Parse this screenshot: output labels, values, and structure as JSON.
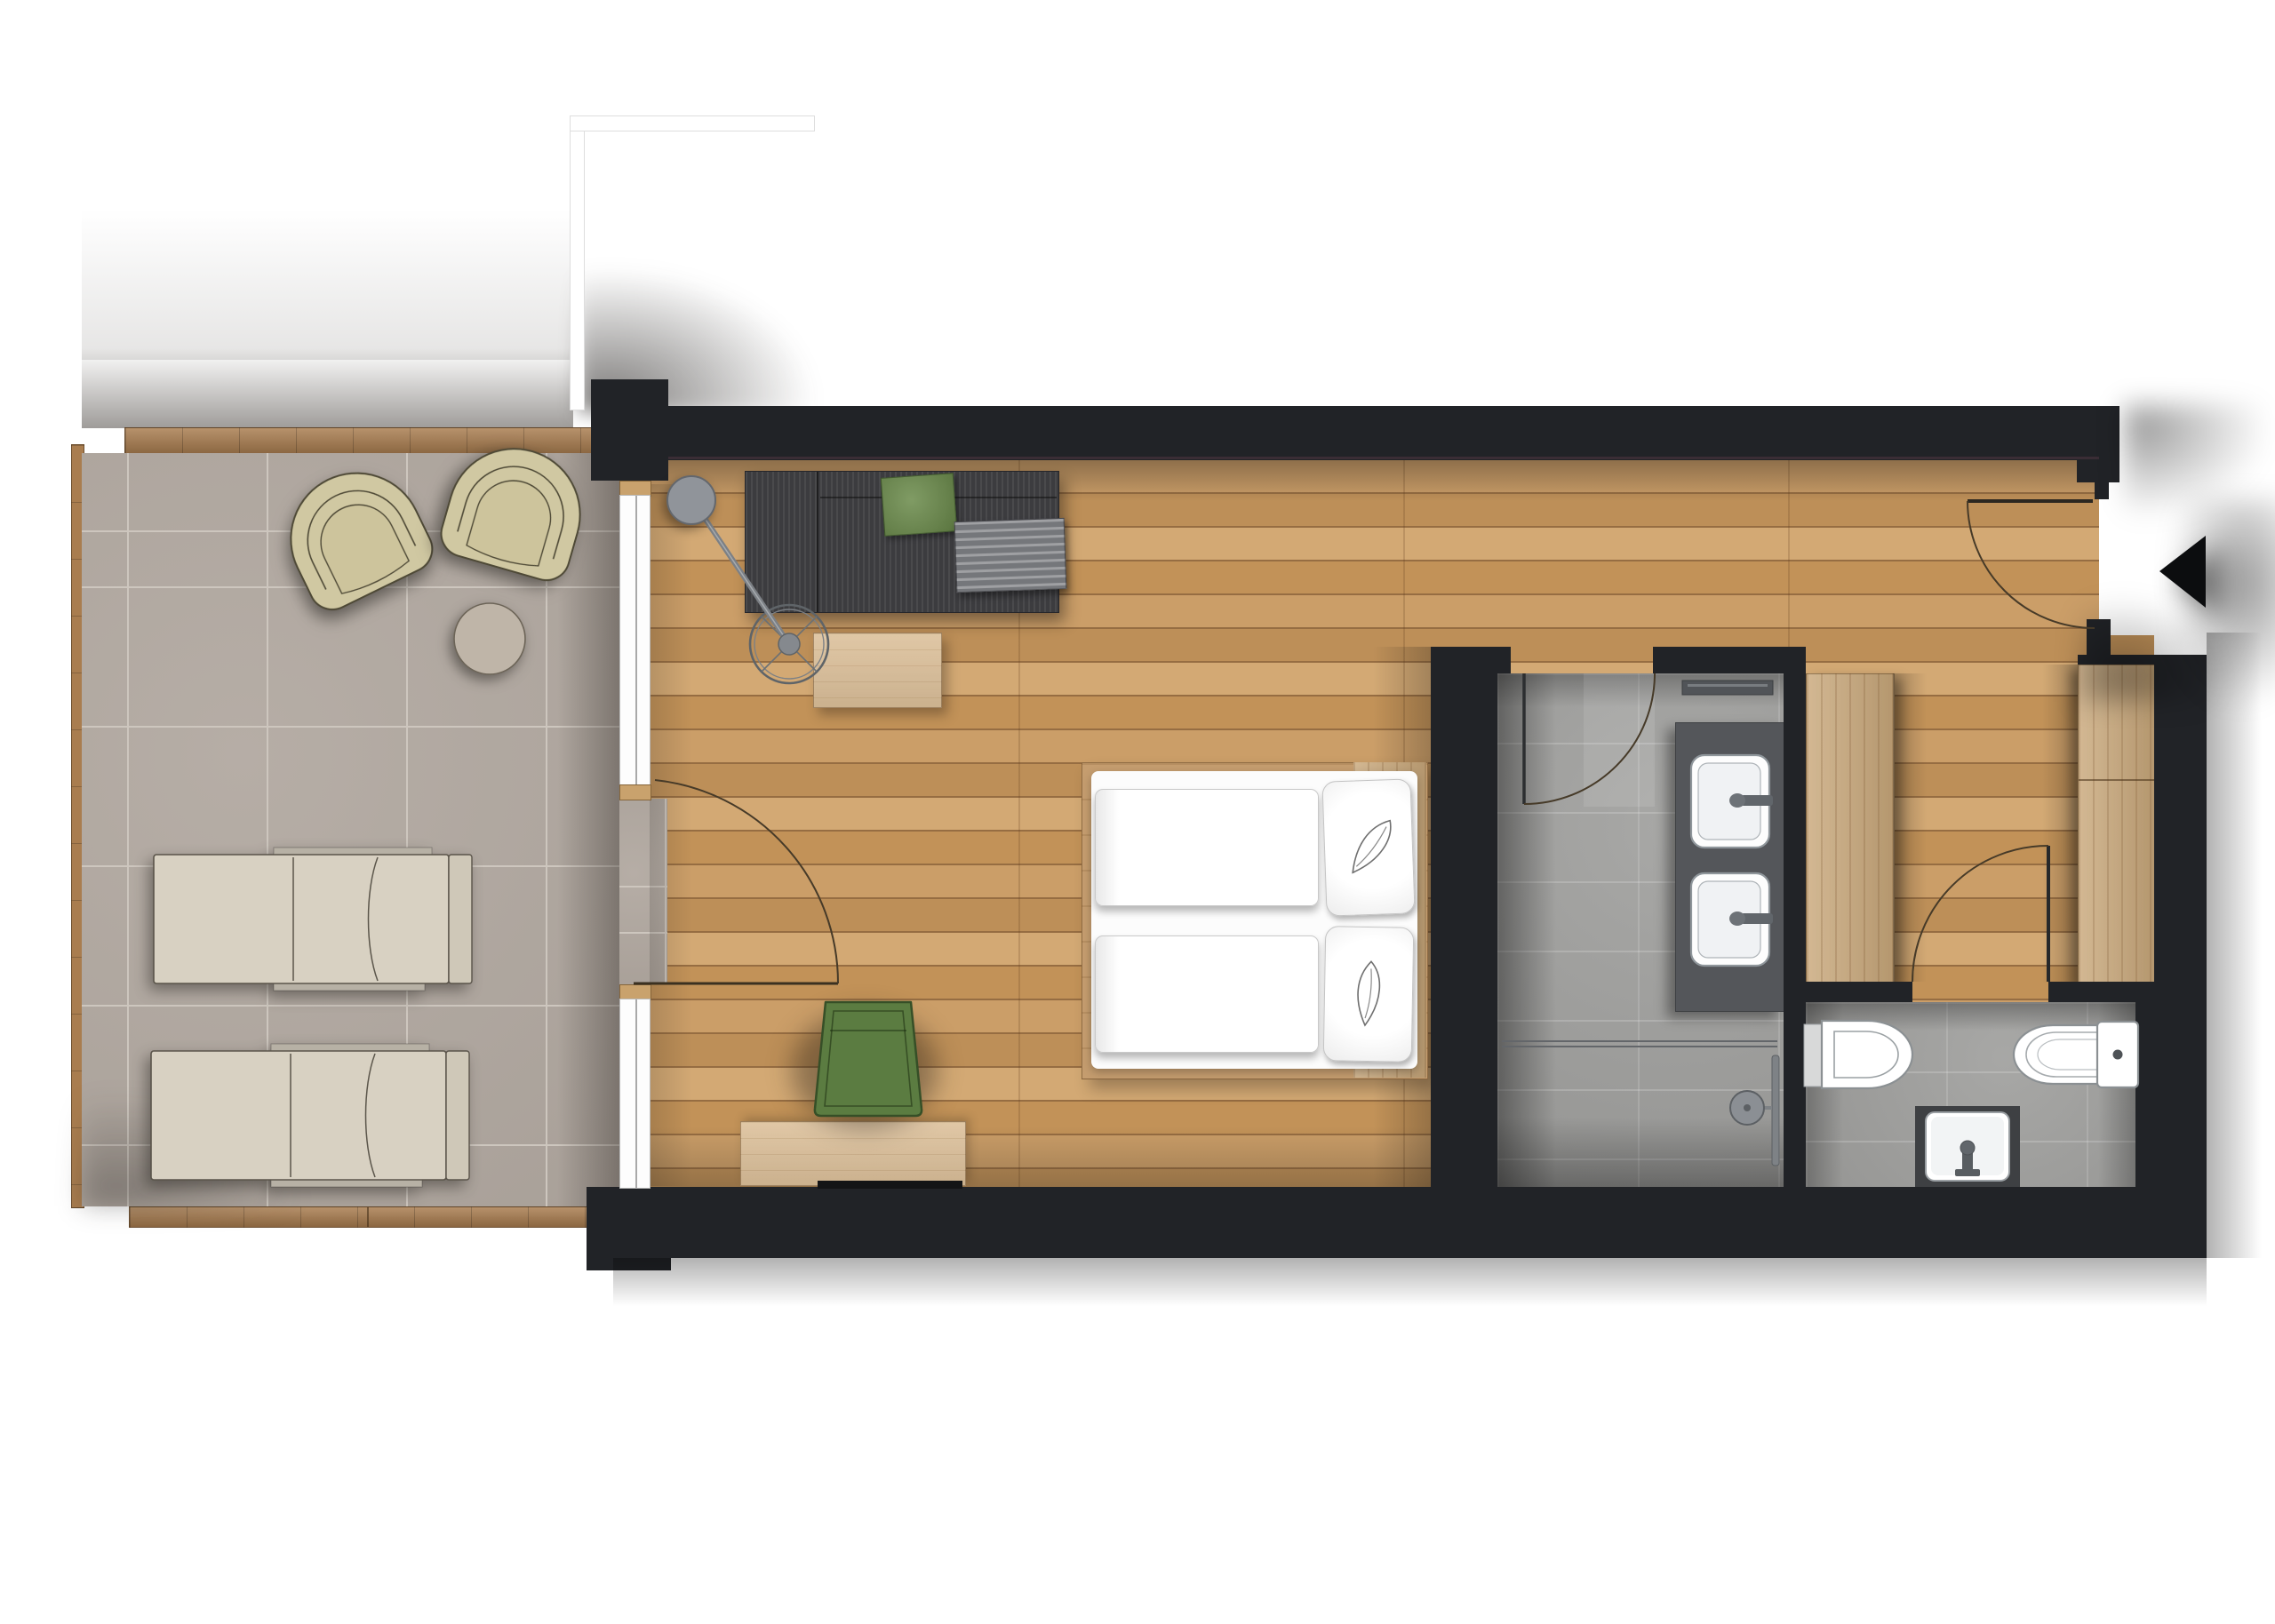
{
  "meta": {
    "kind": "architectural floor plan",
    "view": "top-down rendered plan",
    "scene": "hotel guest room with bathroom, separate WC, entrance hall and terrace",
    "visible_text": "none"
  },
  "colors": {
    "background": "#ffffff",
    "wall": "#212327",
    "wood_floor": "#c49561",
    "terrace_tile": "#b2a9a1",
    "terrace_grout": "#cdc6be",
    "deck_wood": "#a97d4f",
    "bath_tile": "#a2a2a0",
    "vanity_counter": "#54565a",
    "fixture_white": "#fdfdfd",
    "sofa": "#3c3c3f",
    "blanket": "#75777b",
    "cushion_green": "#6b8b4b",
    "armchair_green": "#5b7c41",
    "outdoor_chair": "#d0c8a2",
    "lounger": "#d8d1c2",
    "light_wood": "#dcc09a",
    "closet_wood": "#c9a87b",
    "bed_platform": "#c59d6f",
    "door_arc": "#463a28",
    "entrance_arrow": "#0c0d0f"
  },
  "rooms": {
    "terrace": {
      "label": "Terrace",
      "floor": "stone tile grid with wood deck edging",
      "items": {
        "armchair_left": "outdoor lounge chair",
        "armchair_right": "outdoor lounge chair",
        "side_table": "round side table",
        "lounger_top": "sun lounger",
        "lounger_bottom": "sun lounger",
        "deck_edges": "wood deck border strips"
      }
    },
    "living_bedroom": {
      "label": "Living and sleeping room",
      "floor": "oak plank flooring",
      "items": {
        "sofa": "charcoal sofa with green cushion and folded blanket",
        "floor_lamp": "arc floor lamp with round spoked base",
        "coffee_table": "light wood coffee table",
        "bed": "double bed with two duvets and two pillows",
        "pillow_decor": "folded towel leaf decoration on each pillow",
        "armchair": "green upholstered chair",
        "sideboard": "light wood sideboard",
        "patio_door": "glazed terrace door with swing arc",
        "window_upper": "floor-to-ceiling glazing",
        "window_lower": "floor-to-ceiling glazing",
        "headboard": "wood headboard panel"
      }
    },
    "bathroom": {
      "label": "Bathroom",
      "floor": "grey stone tiles",
      "items": {
        "vanity": "dark double vanity counter",
        "sink_top": "square basin with mixer tap",
        "sink_bottom": "square basin with mixer tap",
        "shower_glass": "glass shower screen",
        "shower_column": "shower head on vertical rail",
        "wall_rail": "wall mounted rail shelf",
        "door": "inward swinging door with arc"
      }
    },
    "wc": {
      "label": "Separate WC",
      "floor": "grey stone tiles",
      "items": {
        "toilet_left": "wall-hung toilet",
        "toilet_right": "toilet with cistern and flush button",
        "hand_basin": "small hand wash basin with tap",
        "door": "door swinging into hall with arc"
      }
    },
    "hall": {
      "label": "Entrance hall",
      "floor": "oak plank flooring",
      "items": {
        "closet": "built-in closet panel",
        "wardrobe": "built-in wardrobe with divider seam",
        "entrance_door": "entrance door with swing arc",
        "entrance_marker": "black entrance arrow pointing left"
      }
    },
    "surroundings": {
      "label": "Exterior",
      "items": {
        "neighbor_wall": "adjacent building wall outline",
        "shadows": "soft cast shadows around the building"
      }
    }
  }
}
